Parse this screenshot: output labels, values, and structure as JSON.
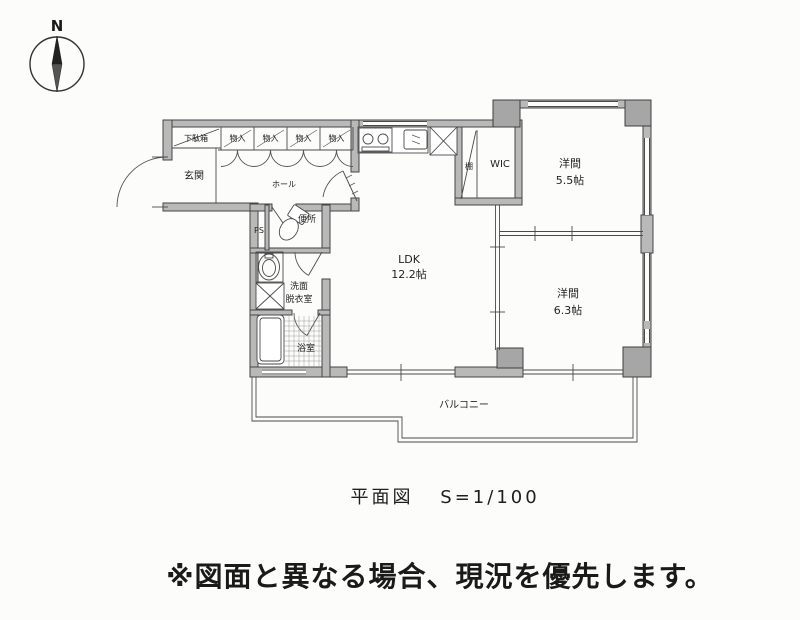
{
  "compass": {
    "label": "N"
  },
  "floor_plan": {
    "rooms": {
      "shoe_cabinet": "下駄箱",
      "closets": [
        "物入",
        "物入",
        "物入",
        "物入"
      ],
      "entrance": "玄関",
      "hall": "ホール",
      "toilet": "便所",
      "pipe_space": "PS",
      "washroom_line1": "洗面",
      "washroom_line2": "脱衣室",
      "bathroom": "浴室",
      "ldk": {
        "name": "LDK",
        "size": "12.2帖"
      },
      "shelf": "棚",
      "wic": "WIC",
      "western_room_1": {
        "name": "洋間",
        "size": "5.5帖"
      },
      "western_room_2": {
        "name": "洋間",
        "size": "6.3帖"
      },
      "balcony": "バルコニー"
    }
  },
  "caption": {
    "title": "平面図",
    "scale": "S=1/100"
  },
  "notice": {
    "text": "※図面と異なる場合、現況を優先します。"
  },
  "colors": {
    "wall_fill": "#b9b9b9",
    "pillar_fill": "#a6a6a6",
    "line": "#454545",
    "text": "#222222"
  }
}
